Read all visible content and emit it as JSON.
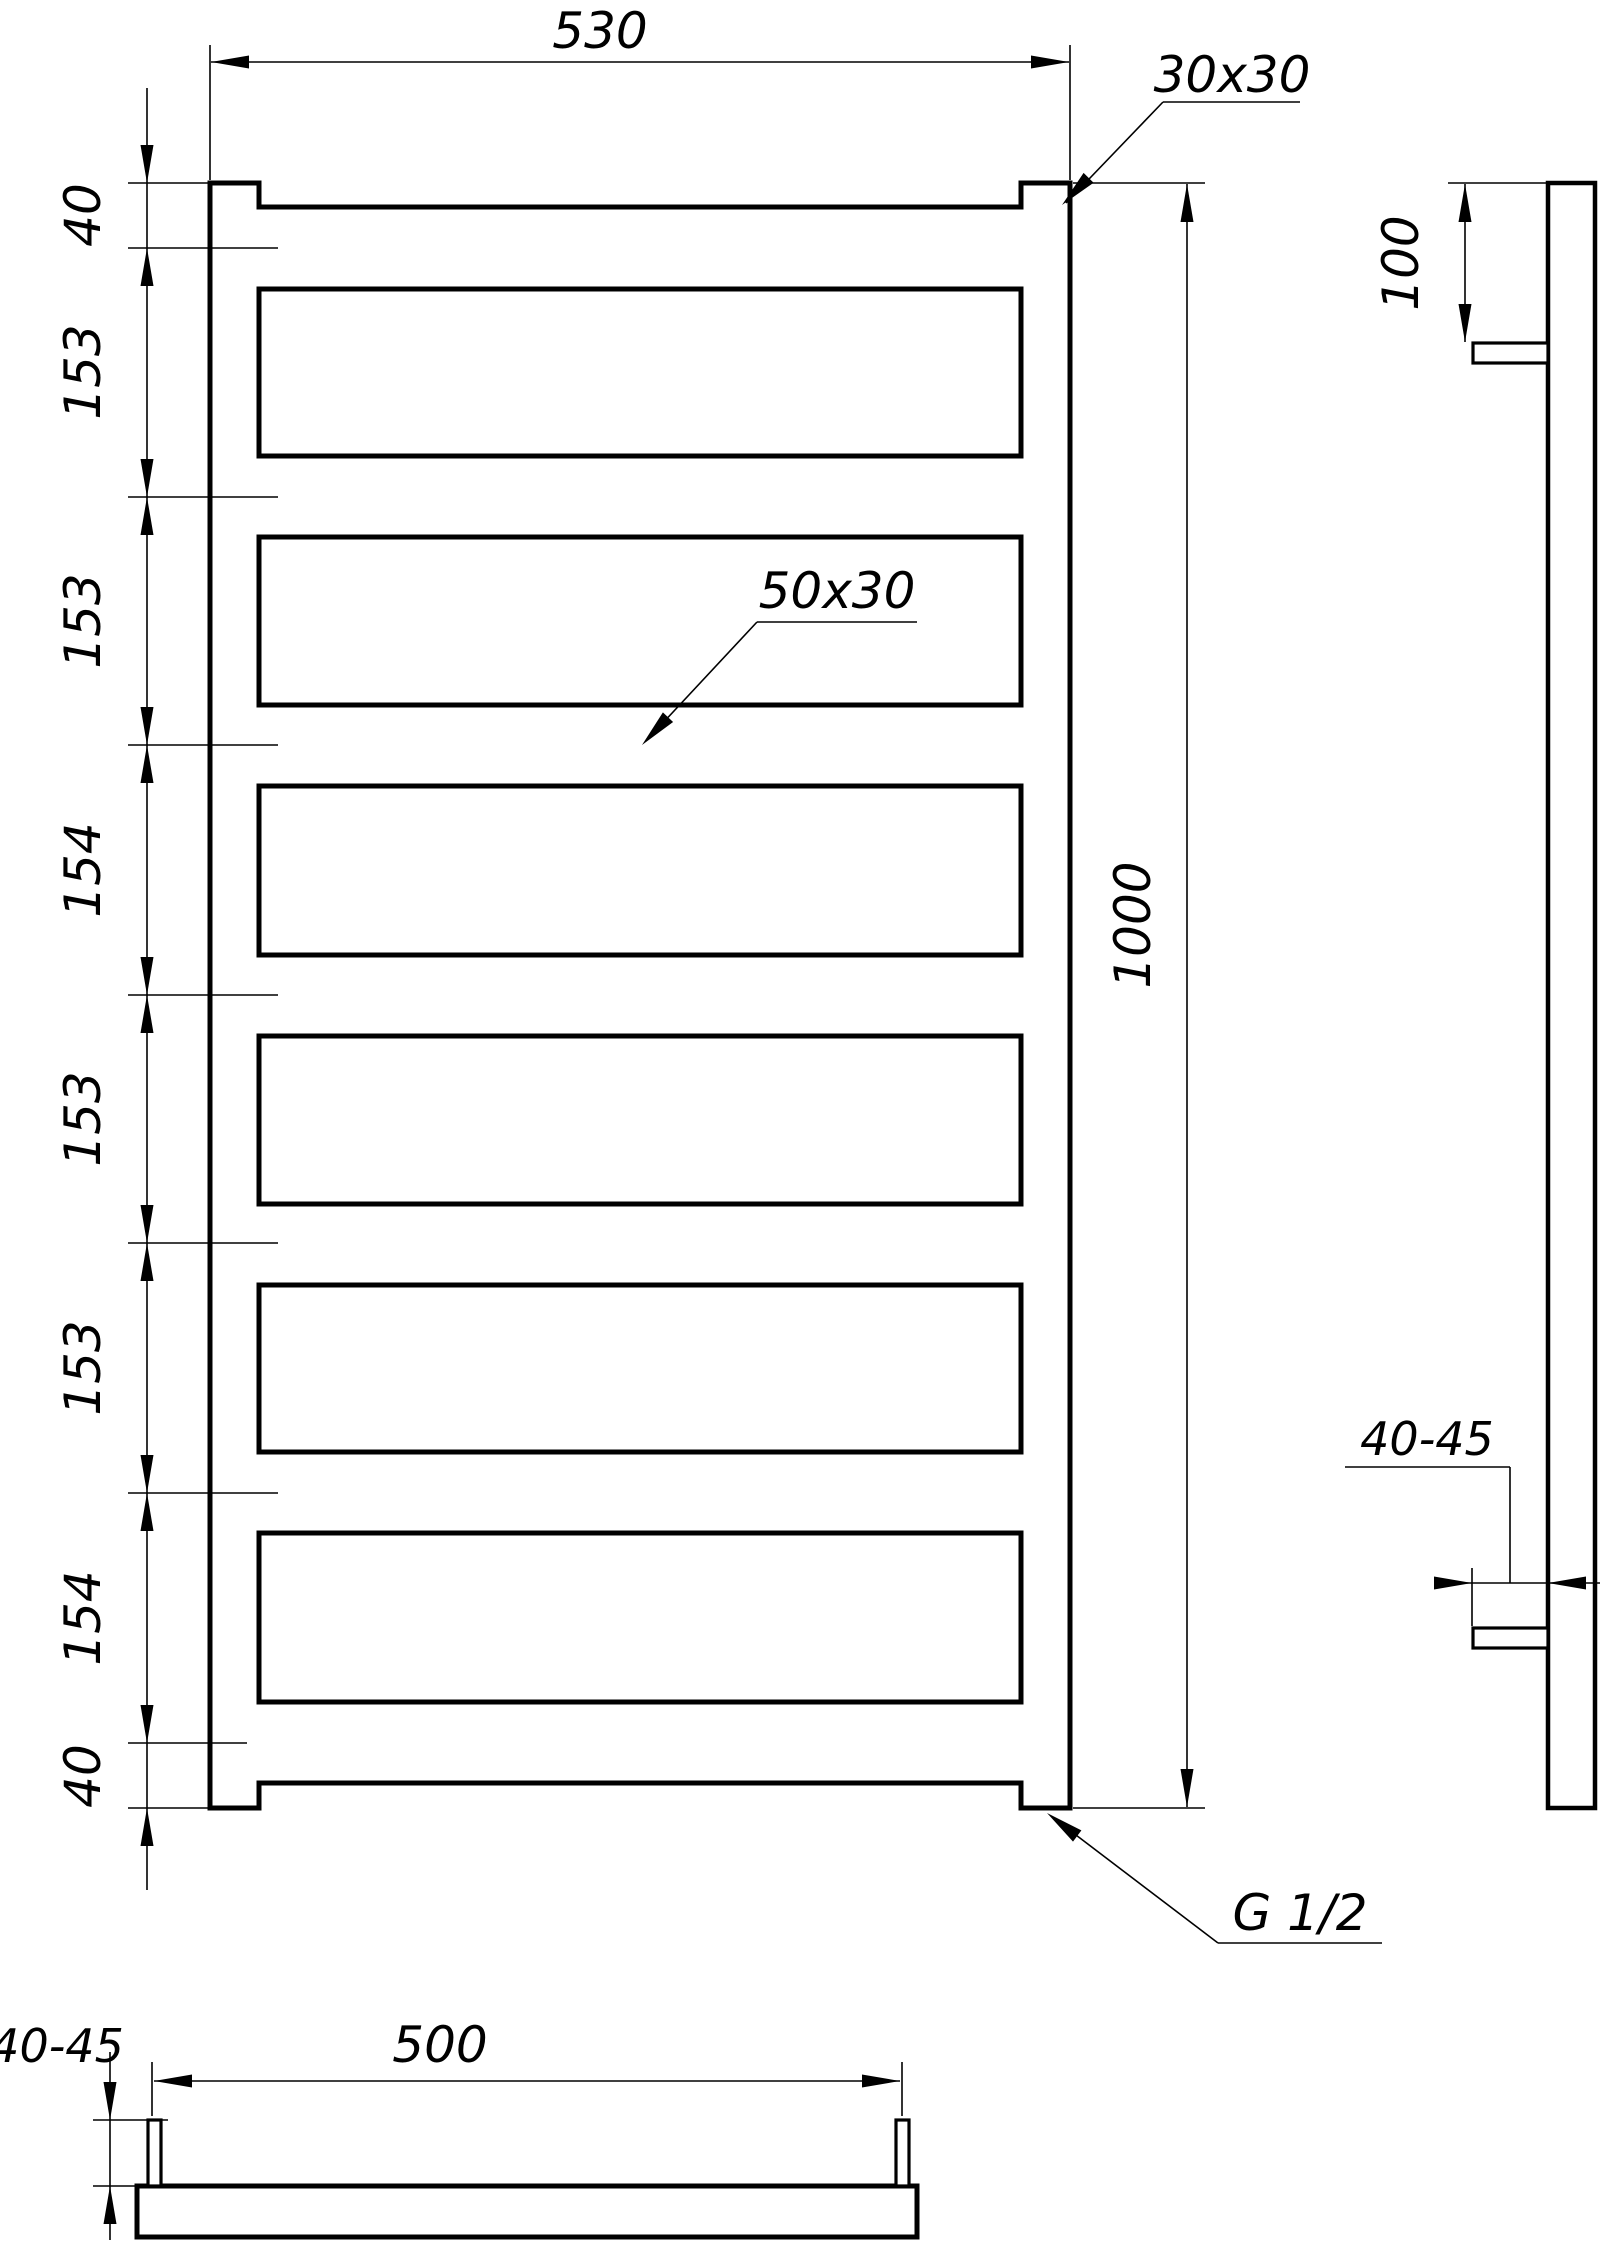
{
  "front_view": {
    "width_dim": "530",
    "height_dim": "1000",
    "corner_profile_label": "30x30",
    "rung_profile_label": "50x30",
    "thread_label": "G 1/2",
    "spacing_dims": [
      "40",
      "153",
      "153",
      "154",
      "153",
      "153",
      "154",
      "40"
    ]
  },
  "side_view": {
    "bracket_top_offset_dim": "100",
    "wall_standoff_dim": "40-45"
  },
  "bottom_view": {
    "wall_standoff_dim": "40-45",
    "bracket_spacing_dim": "500"
  }
}
